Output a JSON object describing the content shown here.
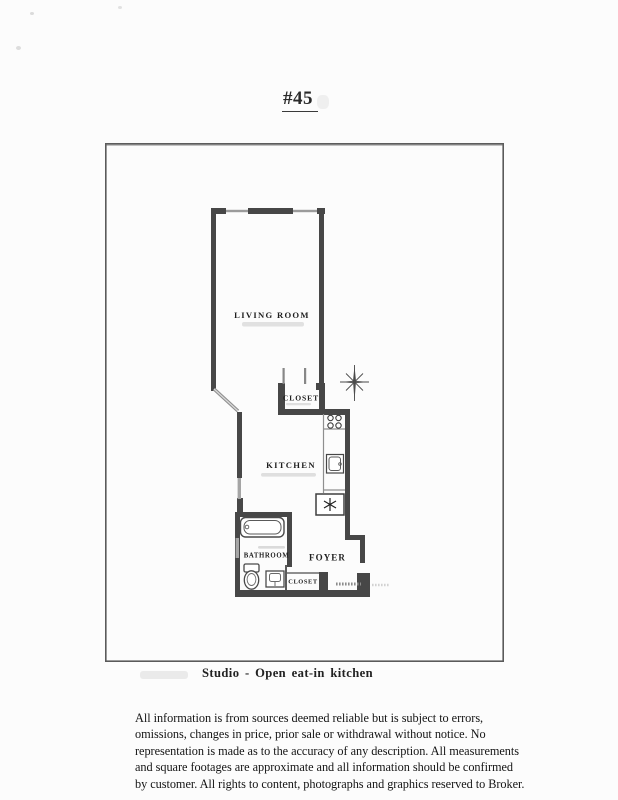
{
  "page": {
    "unit_title": "#45",
    "caption": "Studio - Open eat-in kitchen",
    "disclaimer": {
      "lines": [
        "All information is from sources deemed reliable but is subject to errors,",
        "omissions, changes in price, prior sale or withdrawal without notice. No",
        "representation is made as to the accuracy of any description. All measurements",
        "and square footages are approximate and all information should be confirmed",
        "by customer. All rights to content, photographs and graphics reserved to Broker."
      ]
    }
  },
  "floor_plan": {
    "rooms": {
      "living_room": "LIVING ROOM",
      "closet_upper": "CLOSET",
      "kitchen": "KITCHEN",
      "bathroom": "BATHROOM",
      "foyer": "FOYER",
      "closet_lower": "CLOSET"
    },
    "icons": {
      "compass": "compass-rose-icon",
      "bathtub": "bathtub-icon",
      "toilet": "toilet-icon",
      "bathroom_sink": "bathroom-sink-icon",
      "stove": "stove-burners-icon",
      "kitchen_sink": "kitchen-sink-icon",
      "appliance": "refrigerator-star-icon",
      "entry": "entry-door-icon"
    },
    "colors": {
      "wall": "#474747",
      "window": "#a5a5a5",
      "fixture_stroke": "#3f3f3f",
      "border": "#5a5a5a",
      "label": "#1f1f1f"
    }
  }
}
